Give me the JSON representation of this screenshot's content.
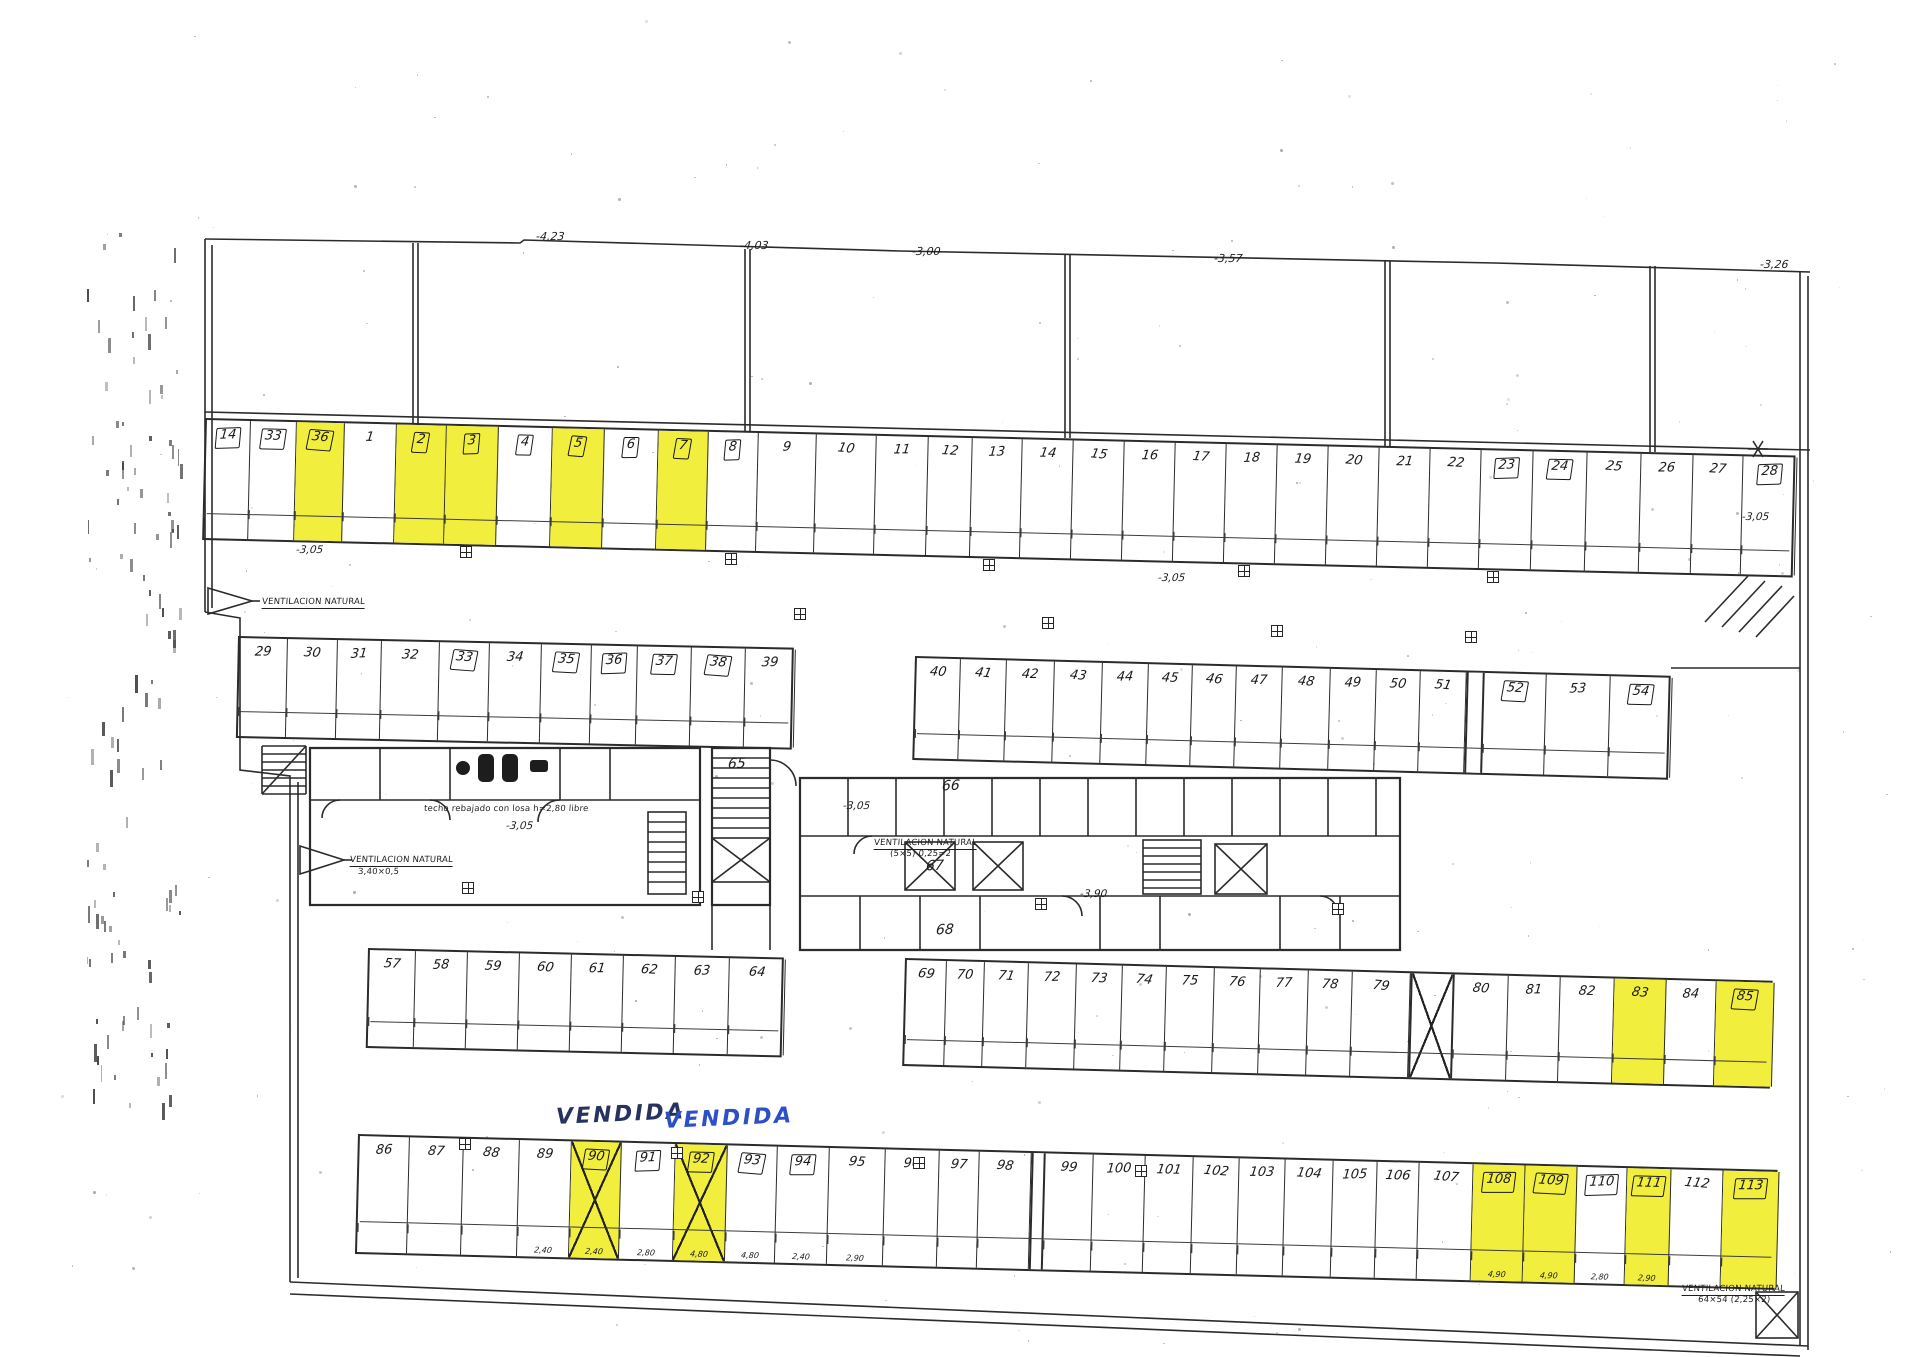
{
  "palette": {
    "ink": "#2b2b2b",
    "highlight": "#f1ee3e",
    "vendida_dark": "#27335f",
    "vendida_blue": "#2d50c7",
    "paper": "#ffffff"
  },
  "top_elevations": [
    {
      "t": "-4,23",
      "x": 536,
      "y": 230
    },
    {
      "t": "-4,03",
      "x": 740,
      "y": 239
    },
    {
      "t": "-3,00",
      "x": 912,
      "y": 245
    },
    {
      "t": "-3,57",
      "x": 1214,
      "y": 252
    },
    {
      "t": "-3,26",
      "x": 1760,
      "y": 258
    }
  ],
  "level_labels": [
    {
      "t": "-3,05",
      "x": 296,
      "y": 544
    },
    {
      "t": "-3,05",
      "x": 1158,
      "y": 572
    },
    {
      "t": "-3,05",
      "x": 1742,
      "y": 511
    },
    {
      "t": "-3,05",
      "x": 506,
      "y": 820
    },
    {
      "t": "-3,05",
      "x": 843,
      "y": 800
    },
    {
      "t": "-3,90",
      "x": 1080,
      "y": 888
    }
  ],
  "core_labels": [
    {
      "t": "65",
      "x": 728,
      "y": 756
    },
    {
      "t": "66",
      "x": 942,
      "y": 778
    },
    {
      "t": "67",
      "x": 926,
      "y": 858
    },
    {
      "t": "68",
      "x": 936,
      "y": 922
    }
  ],
  "annotations": [
    {
      "t": "VENDIDA",
      "x": 556,
      "y": 1102,
      "cls": "vendida dark"
    },
    {
      "t": "VENDIDA",
      "x": 664,
      "y": 1106,
      "cls": "vendida blue"
    },
    {
      "t": "VENTILACION NATURAL",
      "x": 262,
      "y": 597,
      "cls": "tiny u"
    },
    {
      "t": "VENTILACION NATURAL",
      "x": 350,
      "y": 855,
      "cls": "tiny u"
    },
    {
      "t": "3,40×0,5",
      "x": 358,
      "y": 867,
      "cls": "tiny"
    },
    {
      "t": "VENTILACION NATURAL",
      "x": 874,
      "y": 838,
      "cls": "tiny u"
    },
    {
      "t": "(5×5) 0,25=2",
      "x": 890,
      "y": 849,
      "cls": "tiny"
    },
    {
      "t": "techo rebajado con losa h=2,80 libre",
      "x": 424,
      "y": 804,
      "cls": "tiny"
    },
    {
      "t": "VENTILACION NATURAL",
      "x": 1682,
      "y": 1284,
      "cls": "tiny u"
    },
    {
      "t": "64×54 (2,25×2)",
      "x": 1698,
      "y": 1295,
      "cls": "tiny"
    }
  ],
  "rows": [
    {
      "id": "top-row",
      "x": 205,
      "y": 418,
      "w": 1591,
      "h": 122,
      "a": 1.35,
      "low": false,
      "spaces": [
        {
          "n": "14",
          "w": 44,
          "b": 1
        },
        {
          "n": "33",
          "w": 46,
          "b": 1
        },
        {
          "n": "36",
          "w": 48,
          "b": 1,
          "y": 1
        },
        {
          "n": "1",
          "w": 52
        },
        {
          "n": "2",
          "w": 50,
          "b": 1,
          "y": 1
        },
        {
          "n": "3",
          "w": 52,
          "b": 1,
          "y": 1
        },
        {
          "n": "4",
          "w": 54,
          "b": 1
        },
        {
          "n": "5",
          "w": 52,
          "b": 1,
          "y": 1
        },
        {
          "n": "6",
          "w": 54,
          "b": 1
        },
        {
          "n": "7",
          "w": 50,
          "b": 1,
          "y": 1
        },
        {
          "n": "8",
          "w": 50,
          "b": 1
        },
        {
          "n": "9",
          "w": 58
        },
        {
          "n": "10",
          "w": 60
        },
        {
          "n": "11",
          "w": 52
        },
        {
          "n": "12",
          "w": 44
        },
        {
          "n": "13",
          "w": 50
        },
        {
          "n": "14",
          "w": 51
        },
        {
          "n": "15",
          "w": 51
        },
        {
          "n": "16",
          "w": 51
        },
        {
          "n": "17",
          "w": 51
        },
        {
          "n": "18",
          "w": 51
        },
        {
          "n": "19",
          "w": 51
        },
        {
          "n": "20",
          "w": 51
        },
        {
          "n": "21",
          "w": 51
        },
        {
          "n": "22",
          "w": 51
        },
        {
          "n": "23",
          "w": 52,
          "b": 1
        },
        {
          "n": "24",
          "w": 54,
          "b": 1
        },
        {
          "n": "25",
          "w": 54
        },
        {
          "n": "26",
          "w": 52
        },
        {
          "n": "27",
          "w": 50
        },
        {
          "n": "28",
          "w": 54,
          "b": 1
        }
      ]
    },
    {
      "id": "second-row-left",
      "x": 238,
      "y": 636,
      "w": 556,
      "h": 102,
      "a": 1.2,
      "low": false,
      "spaces": [
        {
          "n": "29",
          "w": 48
        },
        {
          "n": "30",
          "w": 50
        },
        {
          "n": "31",
          "w": 44
        },
        {
          "n": "32",
          "w": 58
        },
        {
          "n": "33",
          "w": 50,
          "b": 1
        },
        {
          "n": "34",
          "w": 52
        },
        {
          "n": "35",
          "w": 50,
          "b": 1
        },
        {
          "n": "36",
          "w": 46,
          "b": 1
        },
        {
          "n": "37",
          "w": 54,
          "b": 1
        },
        {
          "n": "38",
          "w": 54,
          "b": 1
        },
        {
          "n": "39",
          "w": 50
        }
      ]
    },
    {
      "id": "second-row-right",
      "x": 915,
      "y": 656,
      "w": 756,
      "h": 104,
      "a": 1.5,
      "low": false,
      "spaces": [
        {
          "n": "40",
          "w": 44
        },
        {
          "n": "41",
          "w": 46
        },
        {
          "n": "42",
          "w": 48
        },
        {
          "n": "43",
          "w": 48
        },
        {
          "n": "44",
          "w": 46
        },
        {
          "n": "45",
          "w": 44
        },
        {
          "n": "46",
          "w": 44
        },
        {
          "n": "47",
          "w": 46
        },
        {
          "n": "48",
          "w": 48
        },
        {
          "n": "49",
          "w": 46
        },
        {
          "n": "50",
          "w": 44
        },
        {
          "n": "51",
          "w": 46
        },
        {
          "t": "wall",
          "w": 18
        },
        {
          "n": "52",
          "w": 62,
          "b": 1
        },
        {
          "n": "53",
          "w": 64
        },
        {
          "n": "54",
          "w": 62,
          "b": 1
        }
      ]
    },
    {
      "id": "third-row-left",
      "x": 368,
      "y": 948,
      "w": 416,
      "h": 100,
      "a": 1.3,
      "low": false,
      "spaces": [
        {
          "n": "57",
          "w": 46
        },
        {
          "n": "58",
          "w": 52
        },
        {
          "n": "59",
          "w": 52
        },
        {
          "n": "60",
          "w": 52
        },
        {
          "n": "61",
          "w": 52
        },
        {
          "n": "62",
          "w": 52
        },
        {
          "n": "63",
          "w": 54
        },
        {
          "n": "64",
          "w": 56
        }
      ]
    },
    {
      "id": "third-row-right",
      "x": 905,
      "y": 958,
      "w": 868,
      "h": 108,
      "a": 1.5,
      "low": false,
      "spaces": [
        {
          "n": "69",
          "w": 40
        },
        {
          "n": "70",
          "w": 38
        },
        {
          "n": "71",
          "w": 44
        },
        {
          "n": "72",
          "w": 48
        },
        {
          "n": "73",
          "w": 46
        },
        {
          "n": "74",
          "w": 44
        },
        {
          "n": "75",
          "w": 48
        },
        {
          "n": "76",
          "w": 46
        },
        {
          "n": "77",
          "w": 48
        },
        {
          "n": "78",
          "w": 44
        },
        {
          "n": "79",
          "w": 58
        },
        {
          "t": "shaft",
          "w": 44
        },
        {
          "n": "80",
          "w": 54
        },
        {
          "n": "81",
          "w": 52
        },
        {
          "n": "82",
          "w": 54
        },
        {
          "n": "83",
          "w": 52,
          "y": 1
        },
        {
          "n": "84",
          "w": 50
        },
        {
          "n": "85",
          "w": 58,
          "b": 1,
          "y": 1
        }
      ]
    },
    {
      "id": "bottom-row",
      "x": 358,
      "y": 1134,
      "w": 1420,
      "h": 120,
      "a": 1.45,
      "low": true,
      "spaces": [
        {
          "n": "86",
          "w": 50
        },
        {
          "n": "87",
          "w": 54
        },
        {
          "n": "88",
          "w": 56
        },
        {
          "n": "89",
          "w": 52,
          "d": "2,40"
        },
        {
          "n": "90",
          "w": 50,
          "b": 1,
          "y": 1,
          "x": 1,
          "d": "2,40"
        },
        {
          "n": "91",
          "w": 54,
          "b": 1,
          "d": "2,80"
        },
        {
          "n": "92",
          "w": 52,
          "b": 1,
          "y": 1,
          "x": 1,
          "d": "4,80"
        },
        {
          "n": "93",
          "w": 50,
          "b": 1,
          "d": "4,80"
        },
        {
          "n": "94",
          "w": 52,
          "b": 1,
          "d": "2,40"
        },
        {
          "n": "95",
          "w": 56,
          "d": "2,90"
        },
        {
          "n": "96",
          "w": 54
        },
        {
          "n": "97",
          "w": 40
        },
        {
          "n": "98",
          "w": 52
        },
        {
          "t": "wall",
          "w": 14
        },
        {
          "n": "99",
          "w": 48
        },
        {
          "n": "100",
          "w": 52
        },
        {
          "n": "101",
          "w": 48
        },
        {
          "n": "102",
          "w": 46
        },
        {
          "n": "103",
          "w": 46
        },
        {
          "n": "104",
          "w": 48
        },
        {
          "n": "105",
          "w": 44
        },
        {
          "n": "106",
          "w": 42
        },
        {
          "n": "107",
          "w": 54
        },
        {
          "n": "108",
          "w": 52,
          "b": 1,
          "y": 1,
          "d": "4,90"
        },
        {
          "n": "109",
          "w": 52,
          "b": 1,
          "y": 1,
          "d": "4,90"
        },
        {
          "n": "110",
          "w": 50,
          "b": 1,
          "d": "2,80"
        },
        {
          "n": "111",
          "w": 44,
          "b": 1,
          "y": 1,
          "d": "2,90"
        },
        {
          "n": "112",
          "w": 52
        },
        {
          "n": "113",
          "w": 56,
          "b": 1,
          "y": 1
        }
      ]
    }
  ]
}
